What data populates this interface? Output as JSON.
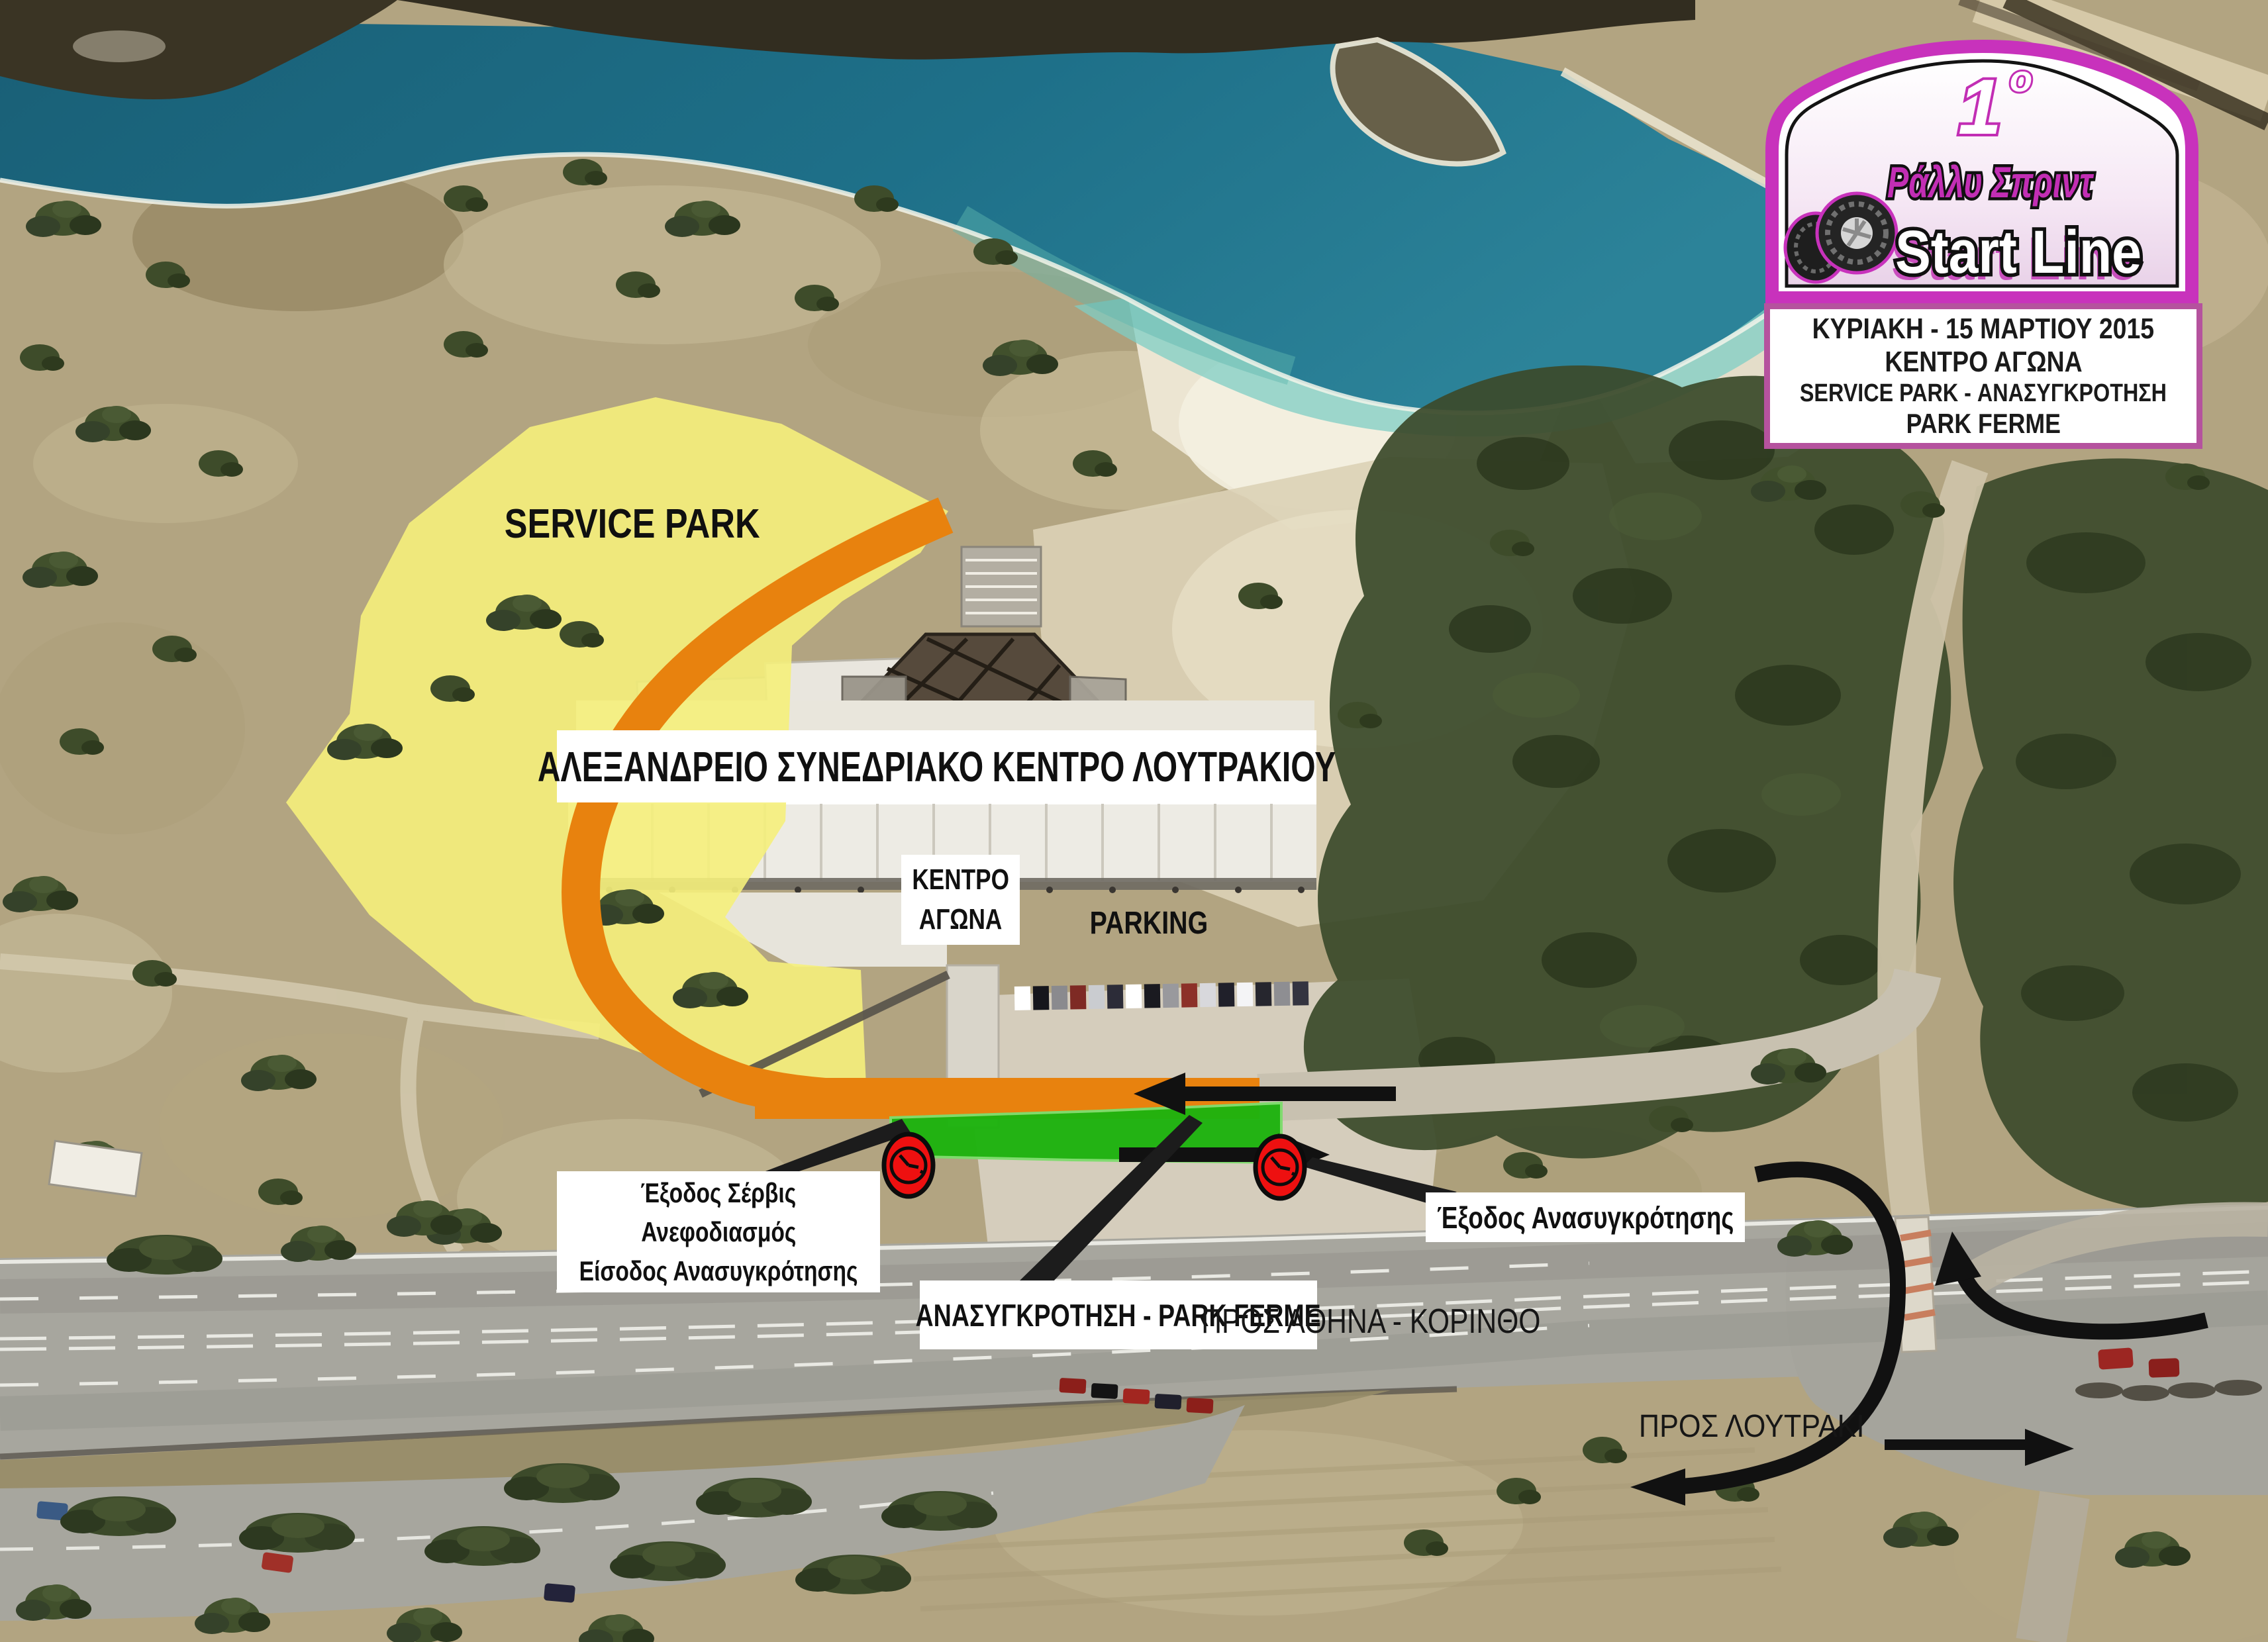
{
  "plate": {
    "edition_number": "1",
    "edition_suffix": "ο",
    "series": "Ράλλυ Σπριντ",
    "name": "Start Line"
  },
  "info_box": {
    "line1": "ΚΥΡΙΑΚΗ - 15 ΜΑΡΤΙΟΥ 2015",
    "line2": "ΚΕΝΤΡΟ ΑΓΩΝΑ",
    "line3": "SERVICE PARK - ΑΝΑΣΥΓΚΡΟΤΗΣΗ",
    "line4": "PARK FERME"
  },
  "map_labels": {
    "service_park": "SERVICE PARK",
    "convention_center": "ΑΛΕΞΑΝΔΡΕΙΟ ΣΥΝΕΔΡΙΑΚΟ ΚΕΝΤΡΟ ΛΟΥΤΡΑΚΙΟΥ",
    "race_hq_line1": "ΚΕΝΤΡΟ",
    "race_hq_line2": "ΑΓΩΝΑ",
    "parking": "PARKING",
    "service_exit_line1": "Έξοδος Σέρβις",
    "service_exit_line2": "Ανεφοδιασμός",
    "service_exit_line3": "Είσοδος Ανασυγκρότησης",
    "regroup_parc_ferme": "ΑΝΑΣΥΓΚΡΟΤΗΣΗ - PARK FERME",
    "regroup_exit": "Έξοδος Ανασυγκρότησης",
    "to_athens_korinthos": "ΠΡΟΣ ΑΘΗΝΑ - ΚΟΡΙΝΘΟ",
    "to_loutraki": "ΠΡΟΣ ΛΟΥΤΡΑΚΙ"
  },
  "legend_colors": {
    "service_park_area": "#f5ef7b",
    "route": "#e8820e",
    "parc_ferme_area": "#1eb30f",
    "time_control": "#ee1010",
    "plate_magenta": "#c832bc"
  }
}
